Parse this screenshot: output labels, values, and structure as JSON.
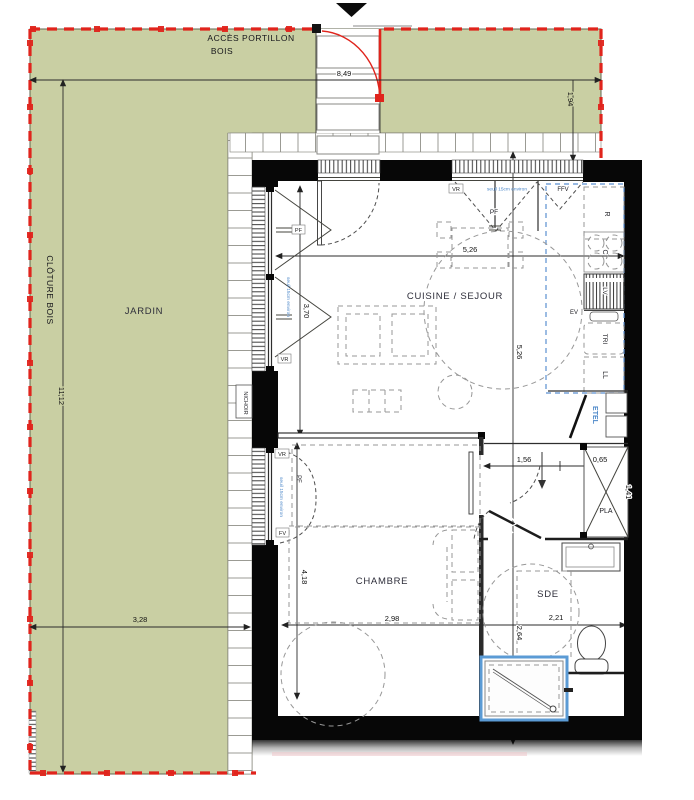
{
  "garden": {
    "acces1": "ACCÈS PORTILLON",
    "acces2": "BOIS",
    "cloture": "CLÔTURE BOIS",
    "jardin": "JARDIN",
    "nichoir": "NICHOIR"
  },
  "rooms": {
    "cuisine": "CUISINE / SEJOUR",
    "chambre": "CHAMBRE",
    "sde": "SDE",
    "pla": "PLA",
    "etel": "ETEL"
  },
  "appliances": {
    "r": "R",
    "c": "C",
    "lv": "LV",
    "ev": "EV",
    "tri": "TRI",
    "ll": "LL"
  },
  "openings": {
    "pf": "PF",
    "ffv": "FFV",
    "vr": "VR",
    "fv": "FV",
    "seuil": "seuil 15cm environ"
  },
  "dims": {
    "w_jardin": "8,49",
    "h_acces": "1,94",
    "h_jardin": "11,12",
    "w_bottom": "3,28",
    "h_bay": "3,70",
    "w_sejour": "5,26",
    "h_sejour": "5,26",
    "hall": "1,56",
    "pla_w": "0,65",
    "pla_h": "1,41",
    "chambre_w": "2,98",
    "sde_w": "2,21",
    "sde_h": "2,64",
    "chambre_h": "4,18"
  },
  "colors": {
    "garden_green": "#c9cfa3",
    "fence_red": "#e0241c",
    "accent_blue": "#4a86c8",
    "shower_blue": "#5b9bd5",
    "wall_black": "#070707"
  }
}
